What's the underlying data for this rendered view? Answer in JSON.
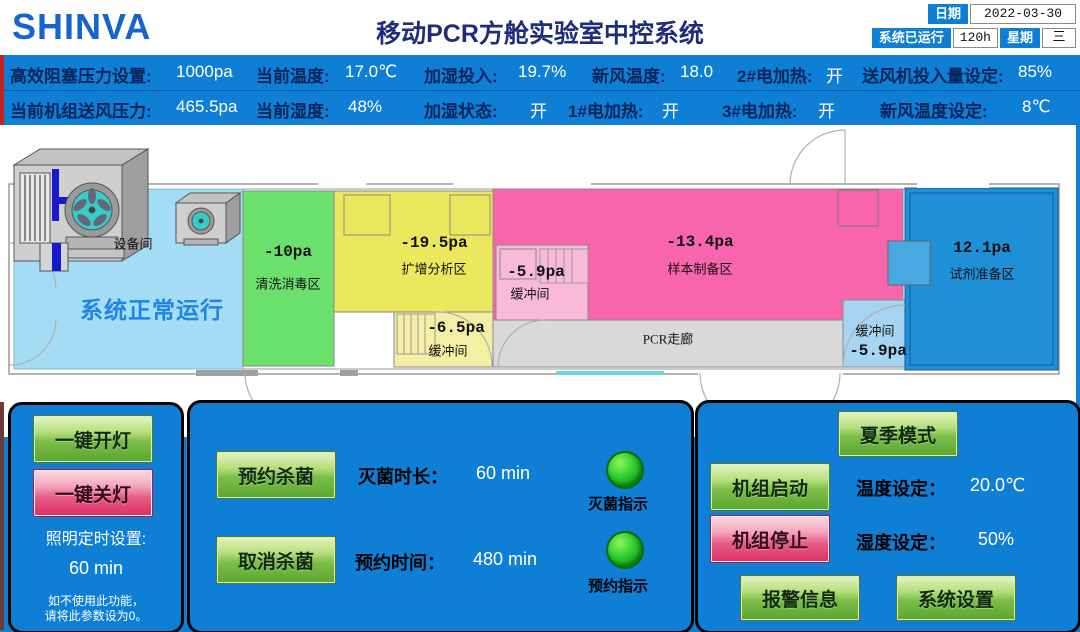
{
  "header": {
    "logo_text": "SHINVA",
    "title": "移动PCR方舱实验室中控系统",
    "date_chip": "日期",
    "date_value": "2022-03-30",
    "runtime_chip": "系统已运行",
    "runtime_value": "120h",
    "weekday_chip": "星期",
    "weekday_value": "三"
  },
  "status_bar": {
    "row1": [
      {
        "label": "高效阻塞压力设置:",
        "value": "1000pa"
      },
      {
        "label": "当前温度:",
        "value": "17.0℃"
      },
      {
        "label": "加湿投入:",
        "value": "19.7%"
      },
      {
        "label": "新风温度:",
        "value": "18.0"
      },
      {
        "label": "2#电加热:",
        "value": "开"
      },
      {
        "label": "送风机投入量设定:",
        "value": "85%"
      }
    ],
    "row2": [
      {
        "label": "当前机组送风压力:",
        "value": "465.5pa"
      },
      {
        "label": "当前湿度:",
        "value": "48%"
      },
      {
        "label": "加湿状态:",
        "value": "开"
      },
      {
        "label": "1#电加热:",
        "value": "开"
      },
      {
        "label": "3#电加热:",
        "value": "开"
      },
      {
        "label": "新风温度设定:",
        "value": "8℃"
      }
    ]
  },
  "floorplan": {
    "system_status": "系统正常运行",
    "equipment_room": "设备间",
    "rooms": {
      "clean": {
        "pressure": "-10pa",
        "name": "清洗消毒区"
      },
      "amplify": {
        "pressure": "-19.5pa",
        "name": "扩增分析区"
      },
      "buffer_amplify": {
        "pressure": "-6.5pa",
        "name": "缓冲间"
      },
      "buffer_sample": {
        "pressure": "-5.9pa",
        "name": "缓冲间"
      },
      "sample": {
        "pressure": "-13.4pa",
        "name": "样本制备区"
      },
      "corridor": {
        "name": "PCR走廊"
      },
      "buffer_reagent": {
        "name": "缓冲间",
        "pressure": "-5.9pa"
      },
      "reagent": {
        "pressure": "12.1pa",
        "name": "试剂准备区"
      }
    }
  },
  "panels": {
    "lighting": {
      "on_button": "一键开灯",
      "off_button": "一键关灯",
      "timer_label": "照明定时设置:",
      "timer_value": "60 min",
      "note_line1": "如不使用此功能，",
      "note_line2": "请将此参数设为0。"
    },
    "sterilization": {
      "reserve_button": "预约杀菌",
      "cancel_button": "取消杀菌",
      "duration_label": "灭菌时长：",
      "duration_value": "60 min",
      "reserve_time_label": "预约时间：",
      "reserve_time_value": "480 min",
      "sterilize_led_label": "灭菌指示",
      "reserve_led_label": "预约指示"
    },
    "hvac": {
      "summer_button": "夏季模式",
      "start_button": "机组启动",
      "stop_button": "机组停止",
      "temp_label": "温度设定：",
      "temp_value": "20.0℃",
      "humidity_label": "湿度设定：",
      "humidity_value": "50%",
      "alarm_button": "报警信息",
      "settings_button": "系统设置"
    }
  },
  "colors": {
    "status_blue": "#0f7fd6",
    "panel_blue": "#0f7fd6",
    "title_navy": "#1f2e7a",
    "logo_blue": "#1565cc",
    "accent_red": "#c22222",
    "room_equipment": "#a5dcf5",
    "room_clean": "#6ce06c",
    "room_amplify": "#ece85e",
    "room_buffer_yellow": "#f3efa5",
    "room_sample": "#f965ad",
    "room_buffer_pink": "#f9bada",
    "room_corridor": "#d9d9d9",
    "room_buffer_blue": "#a6d4f2",
    "room_reagent": "#1f8fd8",
    "led_green": "#2ecc2e",
    "button_green": "#6ab33e",
    "button_red": "#dc2e63",
    "system_status_blue": "#1e86e0"
  }
}
